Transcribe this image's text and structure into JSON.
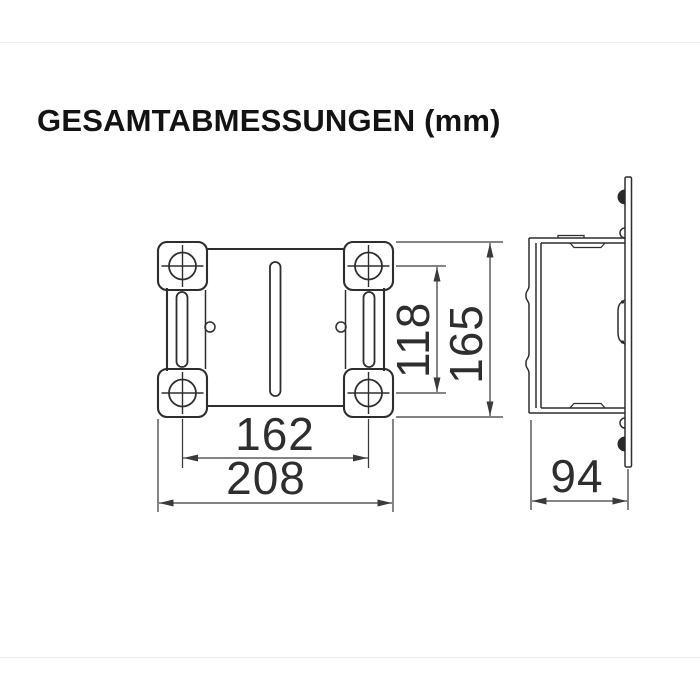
{
  "title": "GESAMTABMESSUNGEN (mm)",
  "dimensions": {
    "front": {
      "hole_spacing_horizontal": "162",
      "overall_width": "208",
      "hole_spacing_vertical": "118",
      "overall_height": "165"
    },
    "side": {
      "overall_depth": "94"
    }
  }
}
